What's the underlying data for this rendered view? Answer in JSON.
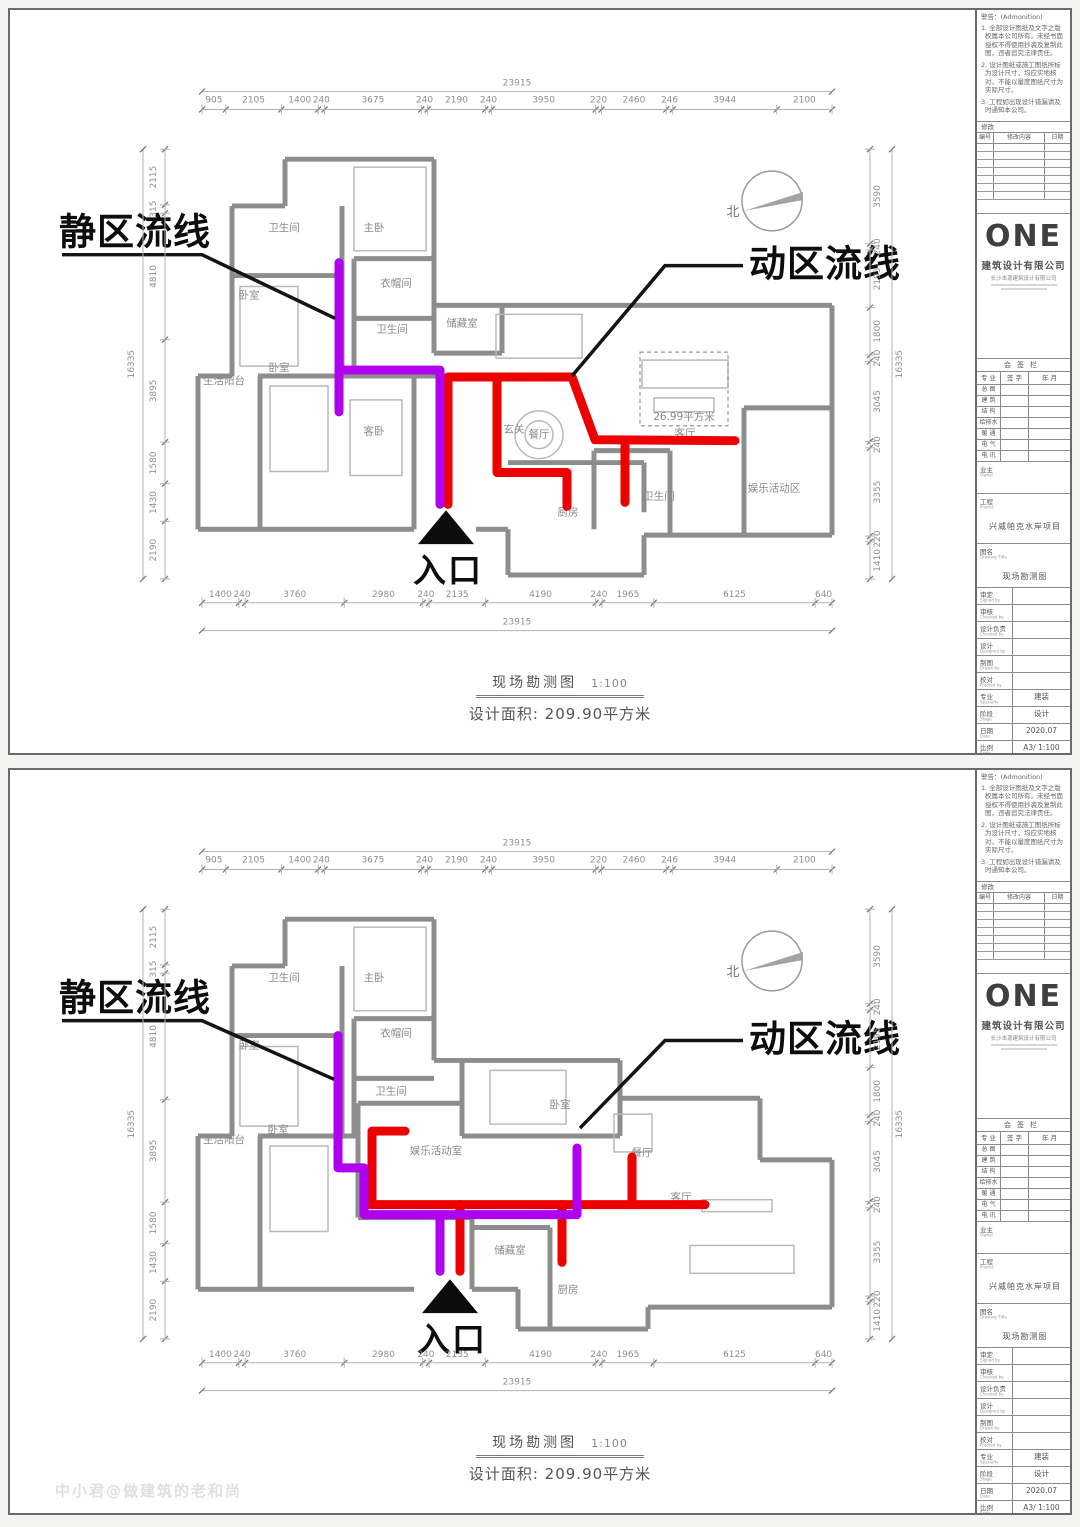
{
  "annotations": {
    "quiet_label": "静区流线",
    "active_label": "动区流线",
    "entrance_label": "入口",
    "north_label": "北",
    "area_label": "26.99平方米"
  },
  "footer": {
    "title": "现场勘测图",
    "scale": "1:100",
    "area_text": "设计面积: 209.90平方米"
  },
  "dims": {
    "top": {
      "total": "23915",
      "segments": [
        "905",
        "2105",
        "1400",
        "240",
        "3675",
        "240",
        "2190",
        "240",
        "3950",
        "220",
        "2460",
        "246",
        "3944",
        "2100"
      ]
    },
    "bottom": {
      "total": "23915",
      "segments": [
        "1400",
        "240",
        "3760",
        "2980",
        "240",
        "2135",
        "4190",
        "240",
        "1965",
        "6125",
        "640"
      ]
    },
    "left": {
      "total": "16335",
      "segments": [
        "2115",
        "315",
        "4810",
        "3895",
        "1580",
        "1430",
        "2190"
      ]
    },
    "right": {
      "total": "16335",
      "segments": [
        "3590",
        "240",
        "2195",
        "1800",
        "240",
        "3045",
        "240",
        "3355",
        "220",
        "1410"
      ]
    }
  },
  "titleblock": {
    "warning_title": "警告：(Admonition)",
    "warnings": [
      "1. 全部设计图纸及文字之版权属本公司所有。未经书面授权不得使用抄袭及复制此图，违者追究法律责任。",
      "2. 设计图纸或施工图纸所标为设计尺寸，均应实地核对，不能以量度图纸尺寸为实际尺寸。",
      "3. 工程如出现设计错漏请及时通知本公司。"
    ],
    "revision": {
      "header": "修改",
      "cols": [
        "编号",
        "修改内容",
        "日期"
      ],
      "empty_rows": 7
    },
    "logo": "ONE",
    "company": "建筑设计有限公司",
    "company_sub": "长沙本源建筑设计有限公司",
    "signoff": {
      "header": "会签栏",
      "cols": [
        "专 业",
        "签 字",
        "年 月"
      ],
      "rows": [
        "总 图",
        "建 筑",
        "结 构",
        "给排水",
        "暖 通",
        "电 气",
        "电 讯"
      ]
    },
    "owner_cn": "业主",
    "owner_en": "Owner",
    "project_cn": "工程",
    "project_en": "Project",
    "project_value": "兴威帕克水岸项目",
    "dwgname_cn": "图名",
    "dwgname_en": "Drawing Title",
    "dwgname_value": "现场勘测图",
    "rows": [
      {
        "cn": "审定",
        "en": "Signed by",
        "value": ""
      },
      {
        "cn": "审核",
        "en": "Checked by",
        "value": ""
      },
      {
        "cn": "设计负责",
        "en": "Checked by",
        "value": ""
      },
      {
        "cn": "设计",
        "en": "Designed by",
        "value": ""
      },
      {
        "cn": "制图",
        "en": "Drawn by",
        "value": ""
      },
      {
        "cn": "校对",
        "en": "Proofed by",
        "value": ""
      },
      {
        "cn": "专业",
        "en": "Specialty",
        "value": "建装"
      },
      {
        "cn": "阶段",
        "en": "Stage",
        "value": "设计"
      },
      {
        "cn": "日期",
        "en": "Date",
        "value": "2020.07"
      },
      {
        "cn": "比例",
        "en": "Scale",
        "value": "A3/ 1:100"
      },
      {
        "cn": "图号",
        "en": "Dwg No.",
        "value": ""
      },
      {
        "cn": "页号",
        "en": "Page",
        "value": ""
      }
    ]
  },
  "flow_colors": {
    "quiet": "#b000f0",
    "active": "#ec0000"
  },
  "sheets": [
    {
      "name": "现场勘测图（流线分析一）",
      "walls": "M283,150 H432 M432,150 V297 M283,150 V197 M230,197 H283 M230,197 V368 M196,368 H230 M196,368 V522 M196,522 H258 M258,368 V522 M258,522 H412 M474,522 H506 M506,522 V568 M506,568 H642 M642,568 V528 M642,528 H830 M830,297 V528 M432,297 H830 M230,267 H340 M340,197 V368 M352,250 H432 M352,310 H432 M352,250 V368 M256,368 H480 M412,368 V522 M432,297 V345 M432,345 H500 M500,297 V345 M592,443 H668 M668,443 V528 M592,443 V522 M506,455 H642 M642,455 V505 M742,400 H830 M742,400 V528",
      "furniture": [
        {
          "k": "rect",
          "x": 352,
          "y": 158,
          "w": 72,
          "h": 84,
          "n": "bed-master"
        },
        {
          "k": "rect",
          "x": 238,
          "y": 278,
          "w": 58,
          "h": 80,
          "n": "bed"
        },
        {
          "k": "rect",
          "x": 268,
          "y": 378,
          "w": 58,
          "h": 86,
          "n": "bed"
        },
        {
          "k": "rect",
          "x": 348,
          "y": 392,
          "w": 52,
          "h": 76,
          "n": "bed-guest"
        },
        {
          "k": "rect",
          "x": 494,
          "y": 306,
          "w": 86,
          "h": 44,
          "n": "long-dining-table"
        },
        {
          "k": "circle",
          "cx": 537,
          "cy": 427,
          "r": 24,
          "n": "round-dining-table"
        },
        {
          "k": "circle",
          "cx": 537,
          "cy": 427,
          "r": 14,
          "n": "round-dining-table-inner"
        },
        {
          "k": "rect",
          "x": 640,
          "y": 352,
          "w": 86,
          "h": 28,
          "n": "sofa"
        },
        {
          "k": "rect",
          "x": 652,
          "y": 390,
          "w": 60,
          "h": 14,
          "n": "tv-cabinet"
        }
      ],
      "area_box": {
        "x": 638,
        "y": 344,
        "w": 88,
        "h": 74,
        "lx": 682,
        "ly": 412
      },
      "rooms": [
        {
          "t": "卫生间",
          "x": 282,
          "y": 222
        },
        {
          "t": "主卧",
          "x": 372,
          "y": 222
        },
        {
          "t": "卧室",
          "x": 247,
          "y": 290
        },
        {
          "t": "衣帽间",
          "x": 394,
          "y": 278
        },
        {
          "t": "卫生间",
          "x": 390,
          "y": 324
        },
        {
          "t": "储藏室",
          "x": 460,
          "y": 318
        },
        {
          "t": "生活阳台",
          "x": 222,
          "y": 376
        },
        {
          "t": "卧室",
          "x": 277,
          "y": 363
        },
        {
          "t": "客卧",
          "x": 372,
          "y": 427
        },
        {
          "t": "玄关",
          "x": 512,
          "y": 425
        },
        {
          "t": "餐厅",
          "x": 537,
          "y": 430
        },
        {
          "t": "客厅",
          "x": 683,
          "y": 429
        },
        {
          "t": "厨房",
          "x": 566,
          "y": 508
        },
        {
          "t": "卫生间",
          "x": 657,
          "y": 492
        },
        {
          "t": "娱乐活动区",
          "x": 772,
          "y": 484
        }
      ],
      "flow": {
        "quiet": [
          [
            [
              337,
              254
            ],
            [
              337,
              404
            ]
          ],
          [
            [
              337,
              362
            ],
            [
              438,
              362
            ],
            [
              438,
              497
            ]
          ]
        ],
        "active": [
          [
            [
              446,
              497
            ],
            [
              446,
              369
            ],
            [
              570,
              369
            ],
            [
              593,
              432
            ],
            [
              733,
              433
            ]
          ],
          [
            [
              495,
              369
            ],
            [
              495,
              465
            ],
            [
              565,
              465
            ],
            [
              565,
              499
            ]
          ],
          [
            [
              623,
              433
            ],
            [
              623,
              495
            ]
          ]
        ]
      },
      "leaders": {
        "quiet": [
          [
            60,
            246
          ],
          [
            200,
            246
          ],
          [
            333,
            310
          ]
        ],
        "active": [
          [
            741,
            257
          ],
          [
            663,
            257
          ],
          [
            570,
            368
          ]
        ]
      },
      "labels": {
        "quiet": {
          "x": 57,
          "y": 236
        },
        "active": {
          "x": 747,
          "y": 268
        }
      },
      "entrance": {
        "x": 444,
        "y": 503
      }
    },
    {
      "name": "现场勘测图（流线分析二）",
      "walls": "M283,150 H432 M432,150 V292 M283,150 V197 M230,197 H283 M230,197 V368 M196,368 H230 M196,368 V522 M196,522 H258 M258,368 V522 M258,522 H412 M230,267 H340 M340,197 V368 M352,250 H432 M352,310 H432 M352,250 V368 M256,368 H356 M432,292 H618 M618,292 V330 M618,330 H758 M758,330 V392 M758,392 H830 M830,392 V540 M646,540 H830 M646,540 V562 M516,562 H646 M516,522 V562 M470,522 H516 M460,292 V368 M460,368 H618 M618,330 V368 M356,335 H460 M356,335 V450 M356,450 H470 M470,450 V522 M470,460 H548 M548,460 V562",
      "furniture": [
        {
          "k": "rect",
          "x": 352,
          "y": 158,
          "w": 72,
          "h": 84,
          "n": "bed-master"
        },
        {
          "k": "rect",
          "x": 238,
          "y": 278,
          "w": 58,
          "h": 80,
          "n": "bed"
        },
        {
          "k": "rect",
          "x": 268,
          "y": 378,
          "w": 58,
          "h": 86,
          "n": "bed"
        },
        {
          "k": "rect",
          "x": 488,
          "y": 302,
          "w": 76,
          "h": 54,
          "n": "bed"
        },
        {
          "k": "rect",
          "x": 612,
          "y": 346,
          "w": 38,
          "h": 38,
          "n": "square-dining-table"
        },
        {
          "k": "rect",
          "x": 688,
          "y": 478,
          "w": 104,
          "h": 28,
          "n": "sofa"
        },
        {
          "k": "rect",
          "x": 700,
          "y": 432,
          "w": 70,
          "h": 12,
          "n": "tv-cabinet"
        }
      ],
      "area_box": null,
      "rooms": [
        {
          "t": "卫生间",
          "x": 282,
          "y": 212
        },
        {
          "t": "主卧",
          "x": 372,
          "y": 212
        },
        {
          "t": "卧室",
          "x": 247,
          "y": 280
        },
        {
          "t": "衣帽间",
          "x": 394,
          "y": 268
        },
        {
          "t": "卫生间",
          "x": 389,
          "y": 326
        },
        {
          "t": "生活阳台",
          "x": 222,
          "y": 375
        },
        {
          "t": "卧室",
          "x": 276,
          "y": 365
        },
        {
          "t": "娱乐活动室",
          "x": 434,
          "y": 386
        },
        {
          "t": "卧室",
          "x": 558,
          "y": 340
        },
        {
          "t": "餐厅",
          "x": 640,
          "y": 388
        },
        {
          "t": "客厅",
          "x": 679,
          "y": 433
        },
        {
          "t": "储藏室",
          "x": 508,
          "y": 486
        },
        {
          "t": "厨房",
          "x": 566,
          "y": 526
        }
      ],
      "flow": {
        "quiet": [
          [
            [
              336,
              267
            ],
            [
              336,
              400
            ],
            [
              362,
              400
            ],
            [
              362,
              447
            ],
            [
              575,
              447
            ],
            [
              575,
              380
            ]
          ],
          [
            [
              438,
              447
            ],
            [
              438,
              504
            ]
          ]
        ],
        "active": [
          [
            [
              403,
              363
            ],
            [
              370,
              363
            ],
            [
              370,
              437
            ]
          ],
          [
            [
              363,
              437
            ],
            [
              703,
              437
            ]
          ],
          [
            [
              458,
              437
            ],
            [
              458,
              504
            ]
          ],
          [
            [
              560,
              437
            ],
            [
              560,
              495
            ]
          ],
          [
            [
              630,
              437
            ],
            [
              630,
              389
            ]
          ]
        ]
      },
      "leaders": {
        "quiet": [
          [
            60,
            252
          ],
          [
            200,
            252
          ],
          [
            332,
            311
          ]
        ],
        "active": [
          [
            741,
            272
          ],
          [
            663,
            272
          ],
          [
            578,
            360
          ]
        ]
      },
      "labels": {
        "quiet": {
          "x": 57,
          "y": 242
        },
        "active": {
          "x": 747,
          "y": 283
        }
      },
      "entrance": {
        "x": 448,
        "y": 512
      }
    }
  ],
  "watermark": "中小君@做建筑的老和尚"
}
